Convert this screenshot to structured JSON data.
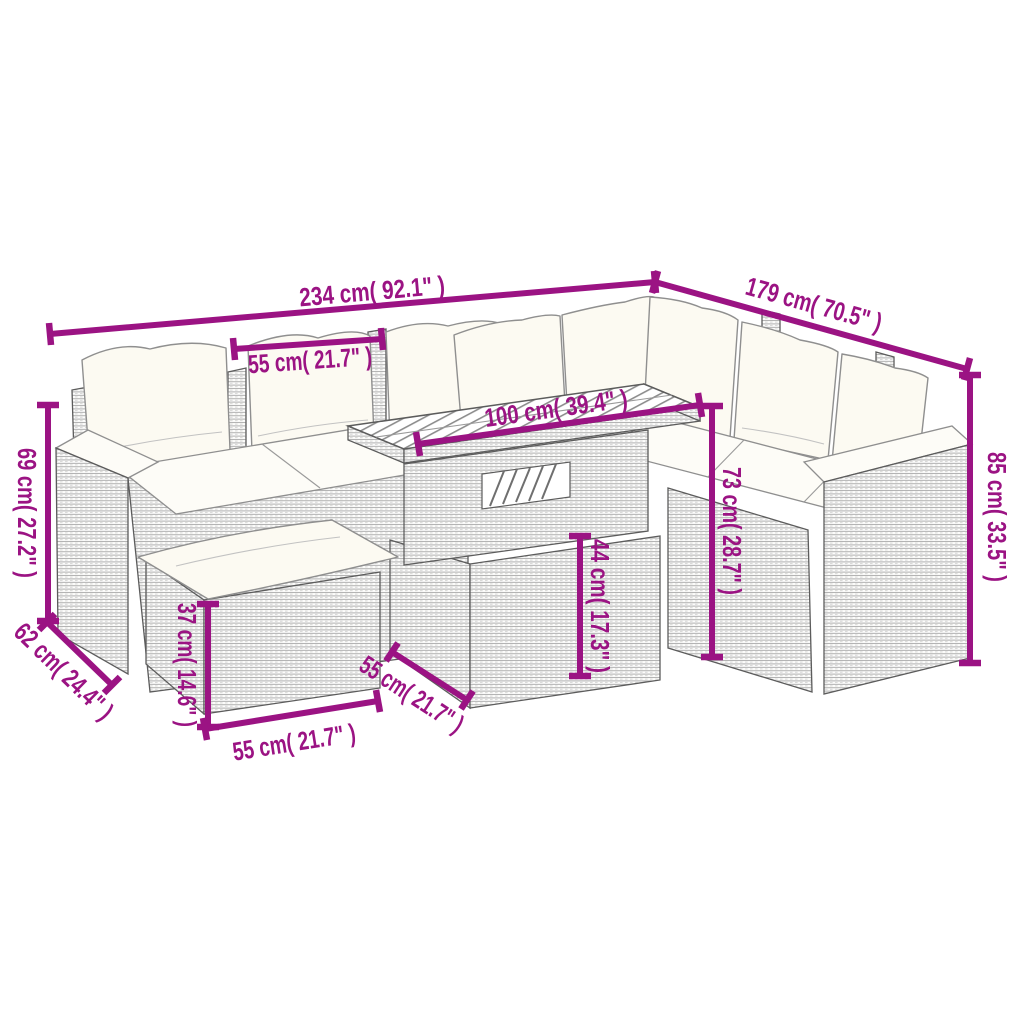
{
  "diagram": {
    "background_color": "#ffffff",
    "accent_color": "#9b1383",
    "illustration": "rattan corner sofa set with ottoman and slatted-top table",
    "dimensions": {
      "total_width": {
        "label": "234 cm( 92.1\" )",
        "cm": "234",
        "inches": "92.1"
      },
      "right_section_depth": {
        "label": "179 cm( 70.5\" )",
        "cm": "179",
        "inches": "70.5"
      },
      "seat_width": {
        "label": "55 cm( 21.7\" )",
        "cm": "55",
        "inches": "21.7"
      },
      "table_length": {
        "label": "100 cm( 39.4\" )",
        "cm": "100",
        "inches": "39.4"
      },
      "arm_height": {
        "label": "69 cm( 27.2\" )",
        "cm": "69",
        "inches": "27.2"
      },
      "seat_depth": {
        "label": "62 cm( 24.4\" )",
        "cm": "62",
        "inches": "24.4"
      },
      "ottoman_height": {
        "label": "37 cm( 14.6\" )",
        "cm": "37",
        "inches": "14.6"
      },
      "ottoman_width": {
        "label": "55 cm( 21.7\" )",
        "cm": "55",
        "inches": "21.7"
      },
      "table_depth": {
        "label": "55 cm( 21.7\" )",
        "cm": "55",
        "inches": "21.7"
      },
      "table_height": {
        "label": "44 cm( 17.3\" )",
        "cm": "44",
        "inches": "17.3"
      },
      "back_height": {
        "label": "73 cm( 28.7\" )",
        "cm": "73",
        "inches": "28.7"
      },
      "total_height": {
        "label": "85 cm( 33.5\" )",
        "cm": "85",
        "inches": "33.5"
      }
    }
  }
}
